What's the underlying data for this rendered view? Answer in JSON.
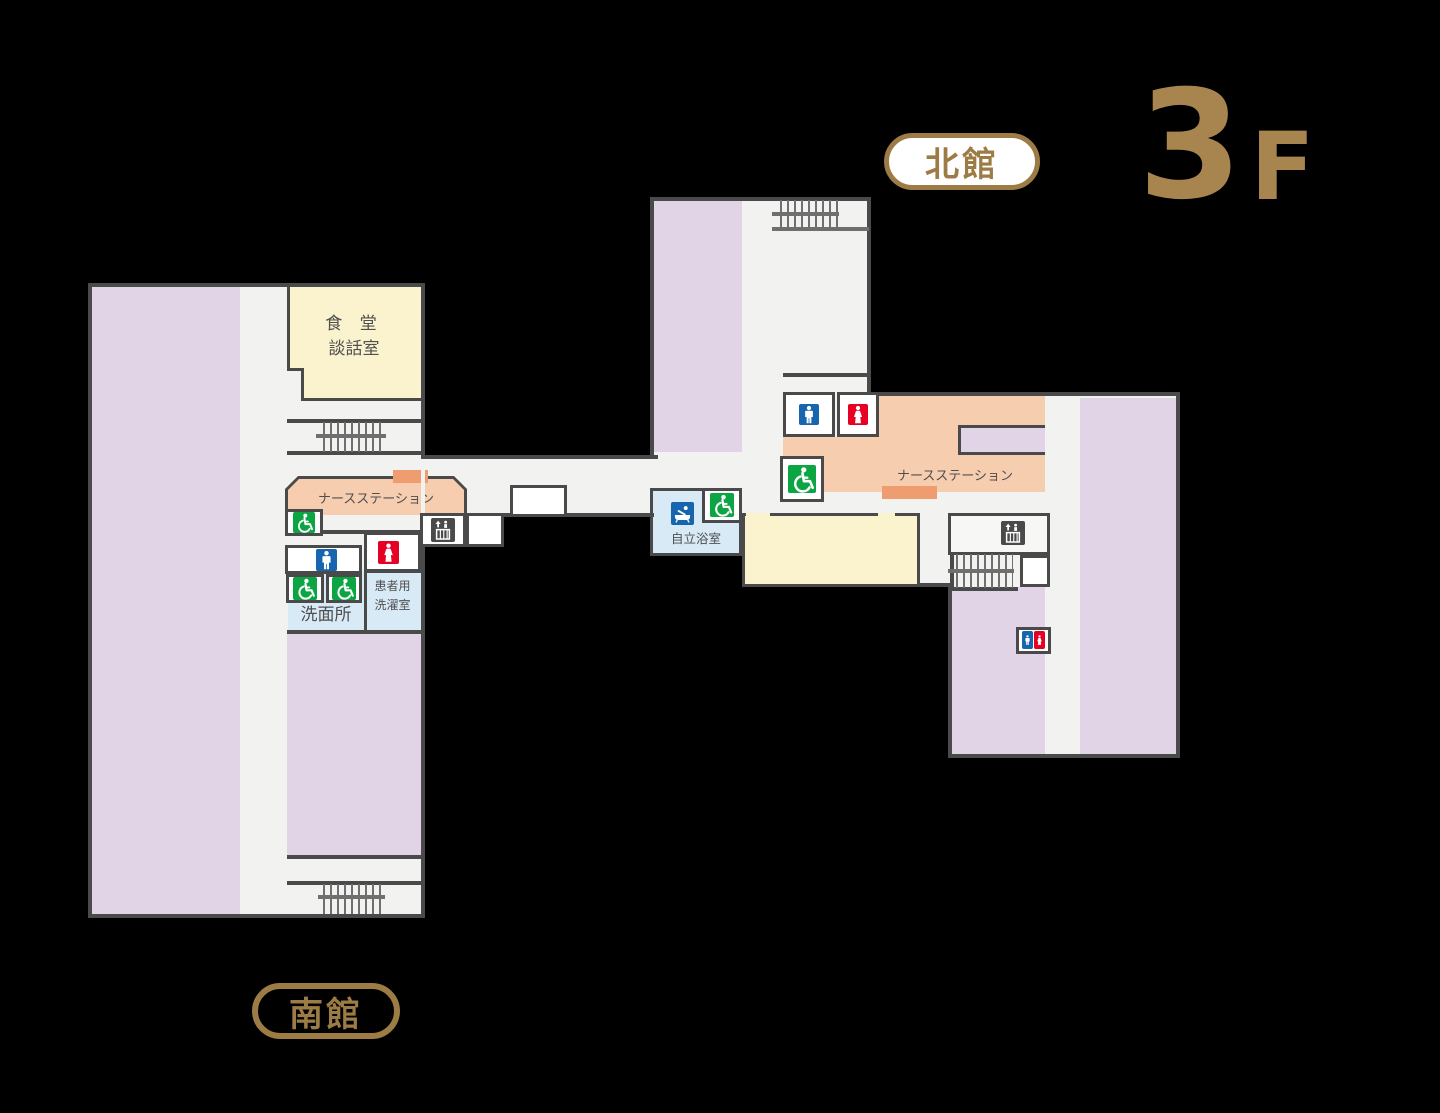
{
  "header": {
    "north_building_label": "北館",
    "floor_number": "3",
    "floor_suffix": "F"
  },
  "footer": {
    "south_building_label": "南館"
  },
  "rooms": {
    "dining_line1": "食 堂",
    "dining_line2": "談話室",
    "nurse_station_south": "ナースステーション",
    "nurse_station_north": "ナースステーション",
    "washroom": "洗面所",
    "patient_laundry_line1": "患者用",
    "patient_laundry_line2": "洗濯室",
    "assisted_bath": "自立浴室"
  },
  "icons": {
    "mens_toilet": "mens-toilet-icon",
    "womens_toilet": "womens-toilet-icon",
    "accessible_toilet": "wheelchair-icon",
    "elevator": "elevator-icon",
    "bath": "bath-icon",
    "stairs": "stairs-glyph"
  },
  "colors": {
    "ward_purple": "#E2D4E7",
    "dining_yellow": "#FAF3CE",
    "nurse_station_orange": "#F7CDB0",
    "counter_orange": "#EF9C70",
    "water_area_blue": "#D8EAF6",
    "floor": "#F2F2F1",
    "wall": "#4A4A4A",
    "accent_brown": "#9C7B45",
    "floor_number_brown": "#A8854F",
    "icon_green": "#0CA543",
    "icon_blue": "#1665AE",
    "icon_red": "#E60023"
  }
}
